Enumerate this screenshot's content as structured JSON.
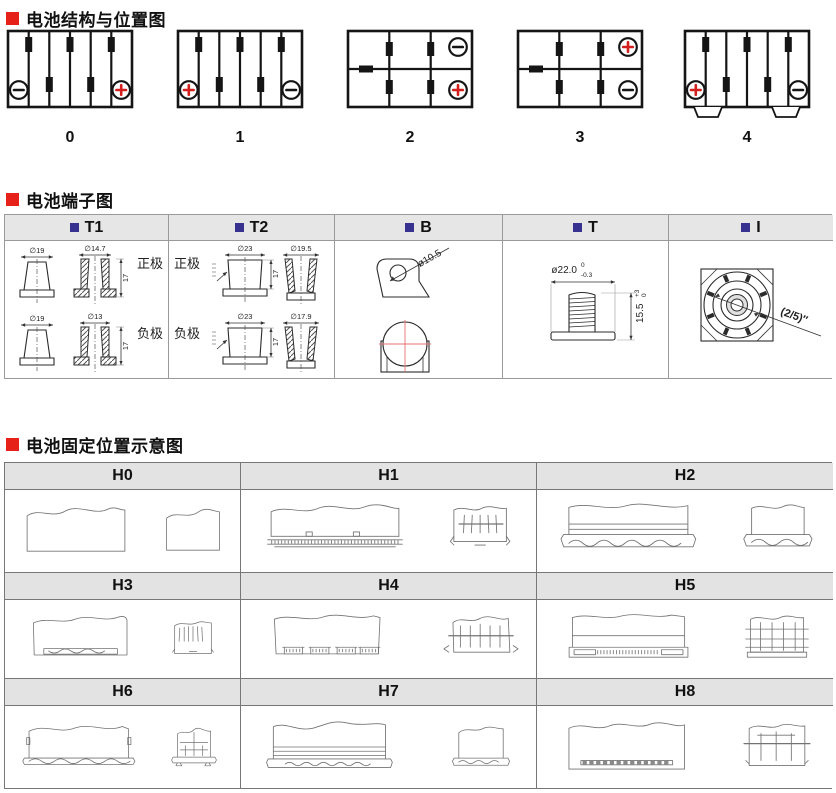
{
  "colors": {
    "accent_red": "#e62119",
    "navy_square": "#37328f",
    "terminal_plus_red": "#d41f1f",
    "table_header_bg": "#e6e6e6"
  },
  "structure": {
    "title": "电池结构与位置图",
    "figures": [
      {
        "label": "0",
        "layout": "6-cells-inline",
        "left_terminal": "negative",
        "right_terminal": "positive"
      },
      {
        "label": "1",
        "layout": "6-cells-inline",
        "left_terminal": "positive",
        "right_terminal": "negative"
      },
      {
        "label": "2",
        "layout": "2x3-grid",
        "top_right_terminal": "negative",
        "bottom_right_terminal": "positive"
      },
      {
        "label": "3",
        "layout": "2x3-grid",
        "top_right_terminal": "positive",
        "bottom_right_terminal": "negative"
      },
      {
        "label": "4",
        "layout": "6-cells-inline-with-feet",
        "left_terminal": "positive",
        "right_terminal": "negative"
      }
    ]
  },
  "terminals": {
    "title": "电池端子图",
    "headers": [
      {
        "label": "T1"
      },
      {
        "label": "T2"
      },
      {
        "label": "B"
      },
      {
        "label": "T"
      },
      {
        "label": "I"
      }
    ],
    "t1": {
      "pos_label": "正极",
      "neg_label": "负极",
      "pos": {
        "post_dia": "∅19",
        "bore_dia": "∅14.7",
        "height": "17"
      },
      "neg": {
        "post_dia": "∅19",
        "bore_dia": "∅13",
        "height": "17"
      }
    },
    "t2": {
      "pos_label": "正极",
      "neg_label": "负极",
      "pos": {
        "post_dia": "∅23",
        "height": "17",
        "bore_dia": "∅19.5"
      },
      "neg": {
        "post_dia": "∅23",
        "height": "17",
        "bore_dia": "∅17.9"
      }
    },
    "b": {
      "hole_dia": "ø10.5"
    },
    "t": {
      "dia": "ø22.0",
      "dia_tol_upper": "0",
      "dia_tol_lower": "-0.3",
      "height": "15.5",
      "height_tol_upper": "+3",
      "height_tol_lower": "0"
    },
    "i": {
      "thread": "(2/5)″"
    }
  },
  "mounting": {
    "title": "电池固定位置示意图",
    "cells": [
      {
        "label": "H0"
      },
      {
        "label": "H1"
      },
      {
        "label": "H2"
      },
      {
        "label": "H3"
      },
      {
        "label": "H4"
      },
      {
        "label": "H5"
      },
      {
        "label": "H6"
      },
      {
        "label": "H7"
      },
      {
        "label": "H8"
      }
    ]
  }
}
